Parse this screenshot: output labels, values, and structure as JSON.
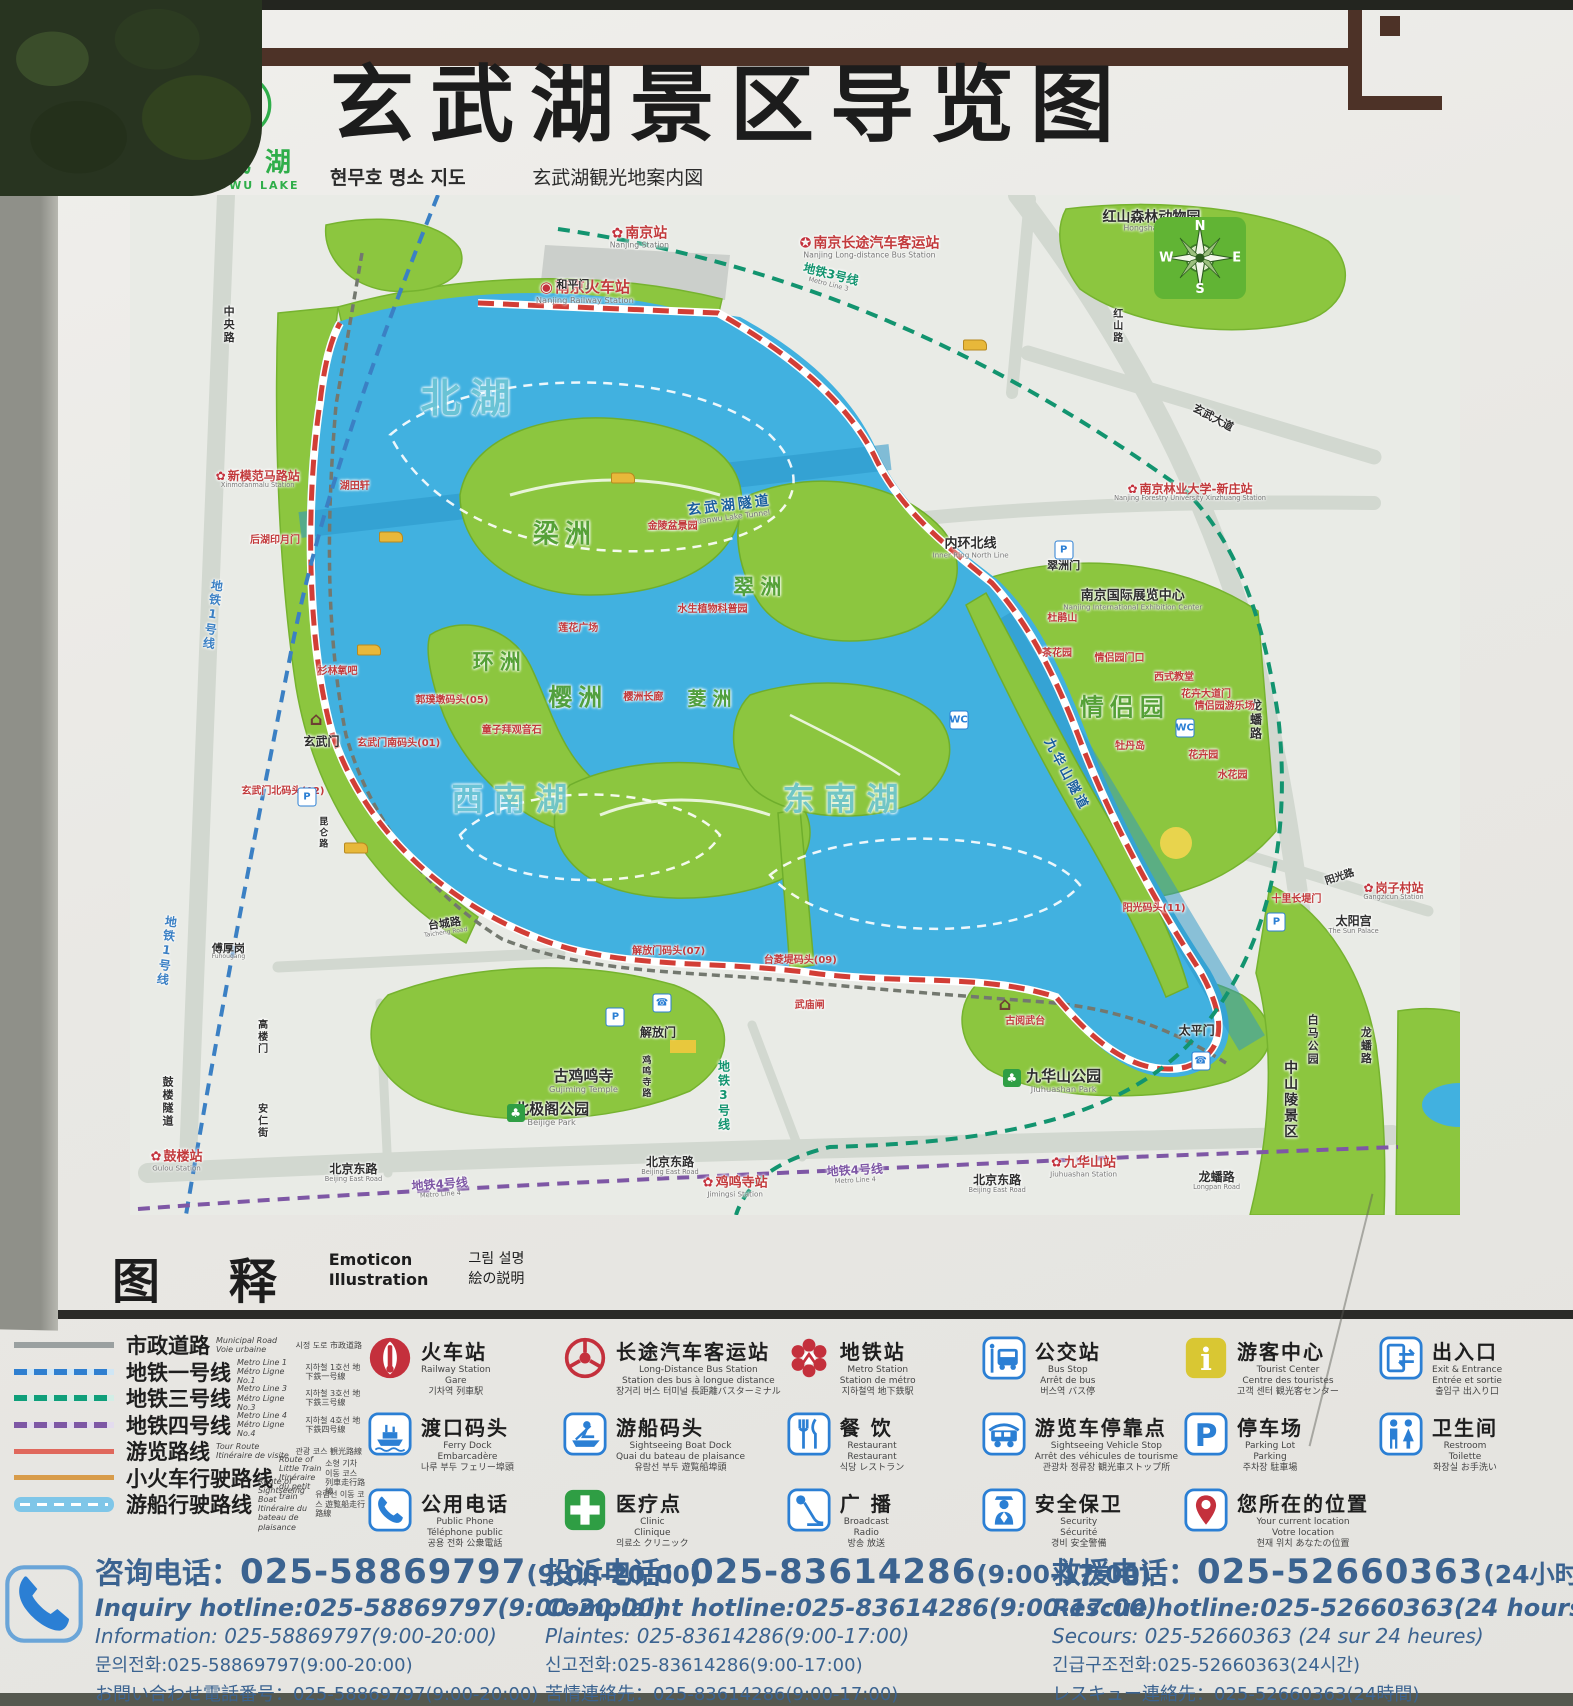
{
  "header": {
    "logo_cn": "玄武湖",
    "logo_en": "XUAN WU LAKE",
    "title": "玄武湖景区导览图",
    "sub_kr": "현무호 명소 지도",
    "sub_jp": "玄武湖観光地案内図",
    "sub_fr": "Sommaire du lieu touristique de lac Xuanwu",
    "sub_en": "Guide map of Xuanwu Lake Scenic Area"
  },
  "colors": {
    "accent_red": "#c4303c",
    "metro_blue": "#3b80c4",
    "metro_teal": "#12946f",
    "metro_purple": "#7e57a5",
    "lake": "#41b1e0",
    "park_green": "#8cc63f",
    "route_red": "#d23e36",
    "hotline_blue": "#3b6390",
    "frame_brown": "#4d3227"
  },
  "map": {
    "compass": {
      "n": "N",
      "e": "E",
      "s": "S",
      "w": "W"
    },
    "glyphs": {
      "p": "P",
      "wc": "WC",
      "ph": "☎",
      "tr": "♣",
      "gt": "⌂"
    },
    "labels": [
      {
        "t": "北湖",
        "x": 25.6,
        "y": 20.0,
        "c": "lk",
        "s": 40
      },
      {
        "t": "西南湖",
        "x": 28.9,
        "y": 59.3,
        "c": "lk",
        "s": 32
      },
      {
        "t": "东南湖",
        "x": 53.8,
        "y": 59.3,
        "c": "lk",
        "s": 32
      },
      {
        "t": "梁洲",
        "x": 32.7,
        "y": 33.3,
        "c": "grn",
        "s": 26
      },
      {
        "t": "环洲",
        "x": 27.8,
        "y": 45.8,
        "c": "grn",
        "s": 21
      },
      {
        "t": "樱洲",
        "x": 33.7,
        "y": 49.3,
        "c": "grn",
        "s": 24
      },
      {
        "t": "菱洲",
        "x": 43.8,
        "y": 49.5,
        "c": "grn",
        "s": 19
      },
      {
        "t": "翠洲",
        "x": 47.4,
        "y": 38.4,
        "c": "grn",
        "s": 21
      },
      {
        "t": "情侣园",
        "x": 74.8,
        "y": 50.3,
        "c": "grn",
        "s": 24
      },
      {
        "t": "南京站",
        "x": 38.3,
        "y": 4.2,
        "c": "red",
        "s": 14,
        "mk": "metro",
        "sub": "Nanjing Station"
      },
      {
        "t": "南京火车站",
        "x": 34.2,
        "y": 9.5,
        "c": "red",
        "s": 15,
        "mk": "train",
        "sub": "Nanjing Railway Station"
      },
      {
        "t": "南京长途汽车客运站",
        "x": 55.6,
        "y": 5.2,
        "c": "red",
        "s": 14,
        "mk": "coach",
        "sub": "Nanjing Long-distance Bus Station"
      },
      {
        "t": "红山森林动物园",
        "x": 76.8,
        "y": 2.6,
        "c": "blk",
        "s": 14,
        "sub": "Hongshan Zoo"
      },
      {
        "t": "新模范马路站",
        "x": 9.6,
        "y": 27.9,
        "c": "red",
        "s": 12,
        "mk": "metro",
        "sub": "Xinmofanmalu Station"
      },
      {
        "t": "南京林业大学-新庄站",
        "x": 79.7,
        "y": 29.2,
        "c": "red",
        "s": 12,
        "mk": "metro",
        "sub": "Nanjing Forestry University Xinzhuang Station"
      },
      {
        "t": "鼓楼站",
        "x": 3.5,
        "y": 94.7,
        "c": "red",
        "s": 13,
        "mk": "metro",
        "sub": "Gulou Station"
      },
      {
        "t": "鸡鸣寺站",
        "x": 45.5,
        "y": 97.3,
        "c": "red",
        "s": 13,
        "mk": "metro",
        "sub": "Jimingsi Station"
      },
      {
        "t": "九华山站",
        "x": 71.7,
        "y": 95.3,
        "c": "red",
        "s": 13,
        "mk": "metro",
        "sub": "Jiuhuashan Station"
      },
      {
        "t": "岗子村站",
        "x": 95.0,
        "y": 68.3,
        "c": "red",
        "s": 12,
        "mk": "metro",
        "sub": "Gangzicun Station"
      },
      {
        "t": "和平门",
        "x": 33.3,
        "y": 8.8,
        "c": "blk",
        "s": 11
      },
      {
        "t": "玄武门",
        "x": 14.4,
        "y": 53.6,
        "c": "blk",
        "s": 12
      },
      {
        "t": "解放门",
        "x": 39.7,
        "y": 82.2,
        "c": "blk",
        "s": 12
      },
      {
        "t": "太平门",
        "x": 80.2,
        "y": 82.0,
        "c": "blk",
        "s": 12
      },
      {
        "t": "翠洲门",
        "x": 70.2,
        "y": 36.4,
        "c": "blk",
        "s": 11
      },
      {
        "t": "太阳宫",
        "x": 92.0,
        "y": 71.6,
        "c": "blk",
        "s": 12,
        "sub": "The Sun Palace"
      },
      {
        "t": "内环北线",
        "x": 63.2,
        "y": 34.6,
        "c": "blk",
        "s": 13,
        "sub": "Inner Ring North Line"
      },
      {
        "t": "南京国际展览中心",
        "x": 75.4,
        "y": 39.7,
        "c": "blk",
        "s": 13,
        "sub": "Nanjing International Exhibition Center"
      },
      {
        "t": "古鸡鸣寺",
        "x": 34.1,
        "y": 86.9,
        "c": "blk",
        "s": 15,
        "sub": "Gujiming Temple"
      },
      {
        "t": "北极阁公园",
        "x": 31.7,
        "y": 90.1,
        "c": "blk",
        "s": 15,
        "sub": "Beijige Park"
      },
      {
        "t": "九华山公园",
        "x": 70.2,
        "y": 86.9,
        "c": "blk",
        "s": 15,
        "sub": "Jiuhuashan Park"
      },
      {
        "t": "傅厚岗",
        "x": 7.4,
        "y": 74.2,
        "c": "blk",
        "s": 11,
        "sub": "Fuhougang"
      },
      {
        "t": "台城路",
        "x": 23.7,
        "y": 71.8,
        "c": "blk",
        "s": 11,
        "r": -8,
        "sub": "Taicheng Road"
      },
      {
        "t": "北京东路",
        "x": 16.8,
        "y": 95.9,
        "c": "blk",
        "s": 12,
        "sub": "Beijing East Road"
      },
      {
        "t": "北京东路",
        "x": 40.6,
        "y": 95.2,
        "c": "blk",
        "s": 12,
        "sub": "Beijing East Road"
      },
      {
        "t": "北京东路",
        "x": 65.2,
        "y": 97.0,
        "c": "blk",
        "s": 12,
        "sub": "Beijing East Road"
      },
      {
        "t": "龙蟠路",
        "x": 84.6,
        "y": 51.5,
        "c": "blk",
        "s": 12,
        "v": true
      },
      {
        "t": "龙蟠路",
        "x": 92.9,
        "y": 83.4,
        "c": "blk",
        "s": 11,
        "v": true
      },
      {
        "t": "龙蟠路",
        "x": 81.7,
        "y": 96.7,
        "c": "blk",
        "s": 12,
        "sub": "Longpan Road"
      },
      {
        "t": "红山路",
        "x": 74.1,
        "y": 12.8,
        "c": "blk",
        "s": 10,
        "v": true
      },
      {
        "t": "玄武大道",
        "x": 81.4,
        "y": 21.9,
        "c": "blk",
        "s": 11,
        "r": 28
      },
      {
        "t": "阳光路",
        "x": 91.0,
        "y": 67.0,
        "c": "blk",
        "s": 10,
        "r": -18
      },
      {
        "t": "中央路",
        "x": 7.4,
        "y": 12.7,
        "c": "blk",
        "s": 11,
        "v": true
      },
      {
        "t": "高楼门",
        "x": 9.8,
        "y": 82.5,
        "c": "blk",
        "s": 10,
        "v": true
      },
      {
        "t": "安仁街",
        "x": 9.8,
        "y": 90.8,
        "c": "blk",
        "s": 10,
        "v": true
      },
      {
        "t": "鼓楼隧道",
        "x": 2.8,
        "y": 88.9,
        "c": "blk",
        "s": 11,
        "v": true
      },
      {
        "t": "鸡鸣寺路",
        "x": 38.7,
        "y": 86.5,
        "c": "blk",
        "s": 9,
        "v": true
      },
      {
        "t": "昆仑路",
        "x": 14.4,
        "y": 62.5,
        "c": "blk",
        "s": 9,
        "v": true
      },
      {
        "t": "白马公园",
        "x": 88.9,
        "y": 82.8,
        "c": "blk",
        "s": 11,
        "v": true
      },
      {
        "t": "中山陵景区",
        "x": 87.2,
        "y": 88.7,
        "c": "blk",
        "s": 14,
        "v": true
      },
      {
        "t": "地铁1号线",
        "x": 6.2,
        "y": 41.2,
        "c": "bl1",
        "s": 12,
        "v": true,
        "r": 8
      },
      {
        "t": "地铁1号线",
        "x": 2.7,
        "y": 74.1,
        "c": "bl1",
        "s": 12,
        "v": true,
        "r": 8
      },
      {
        "t": "地铁3号线",
        "x": 52.6,
        "y": 8.1,
        "c": "te",
        "s": 12,
        "r": 14,
        "sub": "Metro Line 3"
      },
      {
        "t": "地铁3号线",
        "x": 44.6,
        "y": 88.3,
        "c": "te",
        "s": 12,
        "v": true
      },
      {
        "t": "地铁4号线",
        "x": 23.3,
        "y": 97.4,
        "c": "pu",
        "s": 12,
        "r": -4,
        "sub": "Metro Line 4"
      },
      {
        "t": "地铁4号线",
        "x": 54.5,
        "y": 96.0,
        "c": "pu",
        "s": 12,
        "r": -3,
        "sub": "Metro Line 4"
      },
      {
        "t": "玄武湖隧道",
        "x": 45.1,
        "y": 30.9,
        "c": "nvy",
        "s": 14,
        "r": -7,
        "sub": "Xuanwu Lake Tunnel"
      },
      {
        "t": "九华山隧道",
        "x": 70.4,
        "y": 56.9,
        "c": "nvy",
        "s": 13,
        "r": 62
      },
      {
        "t": "湖田轩",
        "x": 16.9,
        "y": 28.6,
        "c": "red",
        "s": 10
      },
      {
        "t": "后湖印月门",
        "x": 10.9,
        "y": 33.9,
        "c": "red",
        "s": 10
      },
      {
        "t": "杉林氧吧",
        "x": 15.6,
        "y": 46.8,
        "c": "red",
        "s": 10
      },
      {
        "t": "玄武门北码头(02)",
        "x": 11.5,
        "y": 58.5,
        "c": "red",
        "s": 10
      },
      {
        "t": "玄武门南码头(01)",
        "x": 20.2,
        "y": 53.8,
        "c": "red",
        "s": 10
      },
      {
        "t": "郭璞墩码头(05)",
        "x": 24.2,
        "y": 49.6,
        "c": "red",
        "s": 10
      },
      {
        "t": "童子拜观音石",
        "x": 28.7,
        "y": 52.5,
        "c": "red",
        "s": 10
      },
      {
        "t": "莲花广场",
        "x": 33.7,
        "y": 42.5,
        "c": "red",
        "s": 10
      },
      {
        "t": "樱洲长廊",
        "x": 38.6,
        "y": 49.3,
        "c": "red",
        "s": 10
      },
      {
        "t": "水生植物科普园",
        "x": 43.8,
        "y": 40.7,
        "c": "red",
        "s": 10
      },
      {
        "t": "金陵盆景园",
        "x": 40.8,
        "y": 32.5,
        "c": "red",
        "s": 10
      },
      {
        "t": "解放门码头(07)",
        "x": 40.5,
        "y": 74.2,
        "c": "red",
        "s": 10
      },
      {
        "t": "台菱堤码头(09)",
        "x": 50.4,
        "y": 75.1,
        "c": "red",
        "s": 10
      },
      {
        "t": "武庙闸",
        "x": 51.1,
        "y": 79.5,
        "c": "red",
        "s": 10
      },
      {
        "t": "古阅武台",
        "x": 67.3,
        "y": 81.1,
        "c": "red",
        "s": 10
      },
      {
        "t": "阳光码头(11)",
        "x": 77.0,
        "y": 70.0,
        "c": "red",
        "s": 10
      },
      {
        "t": "十里长堤门",
        "x": 87.7,
        "y": 69.1,
        "c": "red",
        "s": 10
      },
      {
        "t": "茶花园",
        "x": 69.7,
        "y": 45.0,
        "c": "red",
        "s": 10
      },
      {
        "t": "杜鹃山",
        "x": 70.1,
        "y": 41.6,
        "c": "red",
        "s": 10
      },
      {
        "t": "情侣园门口",
        "x": 74.4,
        "y": 45.5,
        "c": "red",
        "s": 10
      },
      {
        "t": "西式教堂",
        "x": 78.5,
        "y": 47.4,
        "c": "red",
        "s": 10
      },
      {
        "t": "花卉大道门",
        "x": 80.9,
        "y": 49.0,
        "c": "red",
        "s": 10
      },
      {
        "t": "情侣园游乐场",
        "x": 82.3,
        "y": 50.2,
        "c": "red",
        "s": 10
      },
      {
        "t": "牡丹岛",
        "x": 75.2,
        "y": 54.1,
        "c": "red",
        "s": 10
      },
      {
        "t": "花卉园",
        "x": 80.7,
        "y": 55.0,
        "c": "red",
        "s": 10
      },
      {
        "t": "水花园",
        "x": 82.9,
        "y": 57.0,
        "c": "red",
        "s": 10
      }
    ],
    "mini_icons": [
      {
        "k": "p",
        "x": 13.3,
        "y": 59.0
      },
      {
        "k": "p",
        "x": 36.5,
        "y": 80.6
      },
      {
        "k": "p",
        "x": 70.2,
        "y": 34.8
      },
      {
        "k": "p",
        "x": 86.2,
        "y": 71.3
      },
      {
        "k": "wc",
        "x": 62.3,
        "y": 51.5
      },
      {
        "k": "wc",
        "x": 79.3,
        "y": 52.3
      },
      {
        "k": "ph",
        "x": 40.0,
        "y": 79.2
      },
      {
        "k": "ph",
        "x": 80.5,
        "y": 84.9
      },
      {
        "k": "bt",
        "x": 18.0,
        "y": 44.6
      },
      {
        "k": "bt",
        "x": 19.6,
        "y": 33.5
      },
      {
        "k": "bt",
        "x": 37.1,
        "y": 27.7
      },
      {
        "k": "bt",
        "x": 63.5,
        "y": 14.7
      },
      {
        "k": "bt",
        "x": 17.0,
        "y": 64.0
      },
      {
        "k": "tr",
        "x": 29.0,
        "y": 90.0
      },
      {
        "k": "tr",
        "x": 66.3,
        "y": 86.6
      },
      {
        "k": "tr",
        "x": 78.0,
        "y": 4.0
      },
      {
        "k": "gt",
        "x": 14.0,
        "y": 51.4
      },
      {
        "k": "gt",
        "x": 65.8,
        "y": 79.4
      }
    ]
  },
  "legend": {
    "header": {
      "cn": "图 释",
      "en1": "Emoticon",
      "en2": "Illustration",
      "kr": "그림 설명",
      "jp": "絵の説明"
    },
    "routes": [
      {
        "style": "road",
        "cn": "市政道路",
        "en": "Municipal Road",
        "fr": "Voie urbaine",
        "kj": "시정 도로 市政道路"
      },
      {
        "style": "m1",
        "cn": "地铁一号线",
        "en": "Metro Line 1",
        "fr": "Métro Ligne No.1",
        "kj": "지하철 1호선 地下鉄一号線"
      },
      {
        "style": "m3",
        "cn": "地铁三号线",
        "en": "Metro Line 3",
        "fr": "Métro Ligne No.3",
        "kj": "지하철 3호선 地下鉄三号線"
      },
      {
        "style": "m4",
        "cn": "地铁四号线",
        "en": "Metro Line 4",
        "fr": "Métro Ligne No.4",
        "kj": "지하철 4호선 地下鉄四号線"
      },
      {
        "style": "tour",
        "cn": "游览路线",
        "en": "Tour Route",
        "fr": "Itinéraire de visite",
        "kj": "관광 코스 観光路線"
      },
      {
        "style": "train",
        "cn": "小火车行驶路线",
        "en": "Route of Little Train",
        "fr": "Itinéraire du petit train",
        "kj": "소형 기차 이동 코스 列車走行路線"
      },
      {
        "style": "boat",
        "cn": "游船行驶路线",
        "en": "Route of Sightseeing Boat",
        "fr": "Itinéraire du bateau de plaisance",
        "kj": "유람선 이동 코스 遊覧船走行路線"
      }
    ],
    "icons": [
      {
        "icon": "train",
        "cn": "火车站",
        "en": "Railway Station",
        "fr": "Gare",
        "kj": "기차역 列車駅"
      },
      {
        "icon": "ferry",
        "cn": "渡口码头",
        "en": "Ferry Dock",
        "fr": "Embarcadère",
        "kj": "나루 부두 フェリー埠頭"
      },
      {
        "icon": "phone",
        "cn": "公用电话",
        "en": "Public Phone",
        "fr": "Téléphone public",
        "kj": "공용 전화 公衆電話"
      },
      {
        "icon": "coach",
        "cn": "长途汽车客运站",
        "en": "Long-Distance Bus Station",
        "fr": "Station des bus à longue distance",
        "kj": "장거리 버스 터미널 長距離バスターミナル"
      },
      {
        "icon": "boat",
        "cn": "游船码头",
        "en": "Sightseeing Boat Dock",
        "fr": "Quai du bateau de plaisance",
        "kj": "유람선 부두 遊覧船埠頭"
      },
      {
        "icon": "clinic",
        "cn": "医疗点",
        "en": "Clinic",
        "fr": "Clinique",
        "kj": "의료소 クリニック"
      },
      {
        "icon": "metro",
        "cn": "地铁站",
        "en": "Metro Station",
        "fr": "Station de métro",
        "kj": "지하철역 地下鉄駅"
      },
      {
        "icon": "food",
        "cn": "餐 饮",
        "en": "Restaurant",
        "fr": "Restaurant",
        "kj": "식당 レストラン"
      },
      {
        "icon": "mic",
        "cn": "广 播",
        "en": "Broadcast",
        "fr": "Radio",
        "kj": "방송 放送"
      },
      {
        "icon": "bus",
        "cn": "公交站",
        "en": "Bus Stop",
        "fr": "Arrêt de bus",
        "kj": "버스역 バス停"
      },
      {
        "icon": "cart",
        "cn": "游览车停靠点",
        "en": "Sightseeing Vehicle Stop",
        "fr": "Arrêt des véhicules de tourisme",
        "kj": "관광차 정류장 観光車ストップ所"
      },
      {
        "icon": "guard",
        "cn": "安全保卫",
        "en": "Security",
        "fr": "Sécurité",
        "kj": "경비 安全警備"
      },
      {
        "icon": "info",
        "cn": "游客中心",
        "en": "Tourist Center",
        "fr": "Centre des touristes",
        "kj": "고객 센터 観光客センター"
      },
      {
        "icon": "parking",
        "cn": "停车场",
        "en": "Parking Lot",
        "fr": "Parking",
        "kj": "주차장 駐車場"
      },
      {
        "icon": "pin",
        "cn": "您所在的位置",
        "en": "Your current location",
        "fr": "Votre location",
        "kj": "현재 위치 あなたの位置"
      },
      {
        "icon": "exit",
        "cn": "出入口",
        "en": "Exit & Entrance",
        "fr": "Entrée et sortie",
        "kj": "출입구 出入り口"
      },
      {
        "icon": "wc",
        "cn": "卫生间",
        "en": "Restroom",
        "fr": "Toilette",
        "kj": "화장실 お手洗い"
      }
    ]
  },
  "hotlines": [
    {
      "cn": "咨询电话：",
      "num": "025-58869797",
      "hrs": "(9:00-20:00)",
      "lines": [
        "Inquiry hotline:025-58869797(9:00-20:00)",
        "Information: 025-58869797(9:00-20:00)",
        "문의전화:025-58869797(9:00-20:00)",
        "お問い合わせ電話番号：025-58869797(9:00-20:00)"
      ]
    },
    {
      "cn": "投诉电话：",
      "num": "025-83614286",
      "hrs": "(9:00-17:00)",
      "lines": [
        "Complaint hotline:025-83614286(9:00-17:00)",
        "Plaintes: 025-83614286(9:00-17:00)",
        "신고전화:025-83614286(9:00-17:00)",
        "苦情連絡先：025-83614286(9:00-17:00)"
      ]
    },
    {
      "cn": "救援电话：",
      "num": "025-52660363",
      "hrs": "(24小时)",
      "lines": [
        "Rescue hotline:025-52660363(24 hours)",
        "Secours: 025-52660363 (24 sur 24 heures)",
        "긴급구조전화:025-52660363(24시간)",
        "レスキュー連絡先：025-52660363(24時間)"
      ]
    }
  ]
}
